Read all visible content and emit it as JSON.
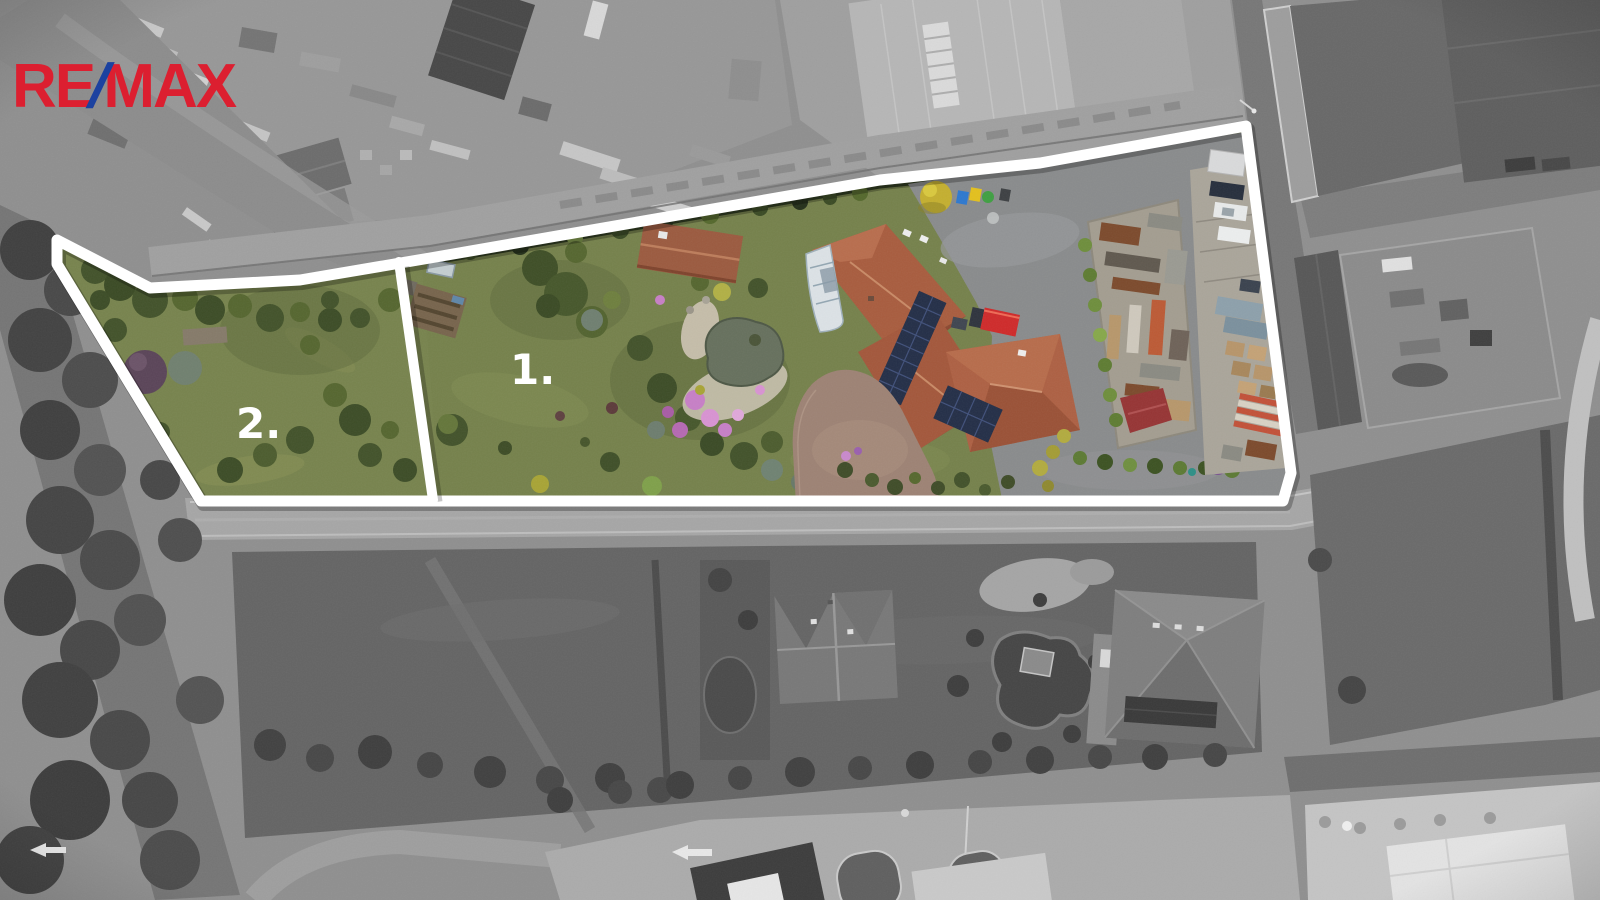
{
  "page": {
    "title": "Aerial drone view of property for sale with highlighted parcels"
  },
  "logo": {
    "re": "RE",
    "slash": "/",
    "max": "MAX"
  },
  "parcels": [
    {
      "id": 1,
      "label": "1."
    },
    {
      "id": 2,
      "label": "2."
    }
  ],
  "overlay": {
    "outline_width": 11,
    "divider_width": 10
  },
  "colors": {
    "logo_red": "#dc1f30",
    "logo_blue": "#1c42a0",
    "outline_white": "#ffffff",
    "label_white": "#ffffff",
    "mono_base_gray": "#8f8f8f",
    "lawn_green": "#75814b",
    "tree_green_dark": "#42522a",
    "tree_green_mid": "#55662f",
    "roof_terracotta": "#a85c3e",
    "solar_navy": "#232e47",
    "asphalt_gray": "#898b8c",
    "pond_gray_green": "#66705d",
    "flower_pink": "#c77fc6",
    "truck_red": "#cf2a2a"
  }
}
